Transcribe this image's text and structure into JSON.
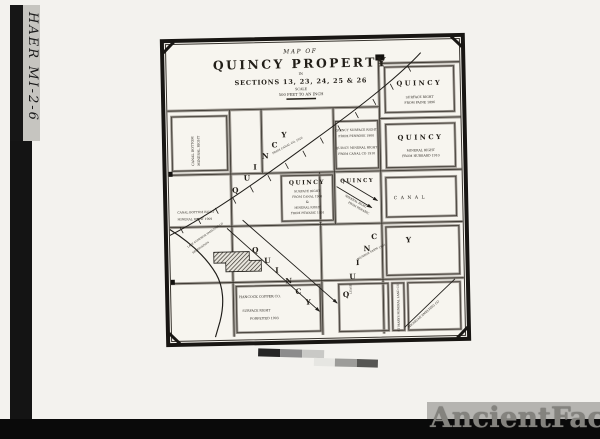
{
  "annotation": {
    "id": "HAER MI-2-6"
  },
  "watermark": {
    "text": "AncientFaces"
  },
  "colors": {
    "paper": "#f7f5ef",
    "ink": "#221e18",
    "band": "#0a0a0a"
  },
  "colorbar": {
    "row1": [
      "#262626",
      "#8c8c8c",
      "#c9c9c6"
    ],
    "row2": [
      "#e6e6e2",
      "#9c9c99",
      "#565653"
    ]
  },
  "map": {
    "title": {
      "line1": "MAP OF",
      "line2": "QUINCY PROPERTY",
      "line3": "IN",
      "line4": "SECTIONS 13, 23, 24, 25 & 26",
      "line5": "SCALE",
      "line6": "500 FEET TO AN INCH"
    },
    "quincy_letters": [
      "Q",
      "U",
      "I",
      "N",
      "C",
      "Y"
    ],
    "labels": {
      "ne": {
        "title": "QUINCY",
        "sub1": "SURFACE RIGHT",
        "sub2": "FROM PAINE 1896"
      },
      "east": {
        "title": "QUINCY",
        "sub1": "MINERAL RIGHT",
        "sub2": "FROM HUBBARD 1910"
      },
      "east_notes": {
        "l1": "QUINCY SURFACE RIGHT",
        "l2": "FROM PENROSE 1900",
        "l3": "QUINCY MINERAL RIGHT",
        "l4": "FROM CANAL CO 1910"
      },
      "center": {
        "title": "QUINCY",
        "l1": "SURFACE RIGHT",
        "l2": "FROM CANAL 1900",
        "l3": "&",
        "l4": "MINERAL RIGHT",
        "l5": "FROM PEWABIC 1901"
      },
      "center_right": {
        "title": "QUINCY",
        "d1": "MINERAL RIGHT",
        "d2": "FROM PEWABIC"
      },
      "canal": "CANAL",
      "west_vertical": {
        "l1": "CANAL BOTTOM",
        "l2": "MINERAL RIGHT"
      },
      "west": {
        "l1": "CANAL BOTTOM RIGHT",
        "l2": "MINERAL RIGHT 1909"
      },
      "sw": {
        "l1": "HANCOCK COPPER CO.",
        "l2": "SURFACE RIGHT",
        "l3": "FORFEITED 1903"
      },
      "smelter": {
        "l1": "LAKE SUPERIOR SMELTING CO",
        "l2": "RESERVATION"
      },
      "rail_note": "FROM CANAL CO. 1910",
      "farm_note": {
        "name": "MUNROE FARM",
        "year": "1901"
      },
      "lease": "LEASE",
      "st_marys": "ST MARYS MINERAL LAND CO",
      "smelting_diag": "MICHIGAN SMELTING CO"
    }
  }
}
